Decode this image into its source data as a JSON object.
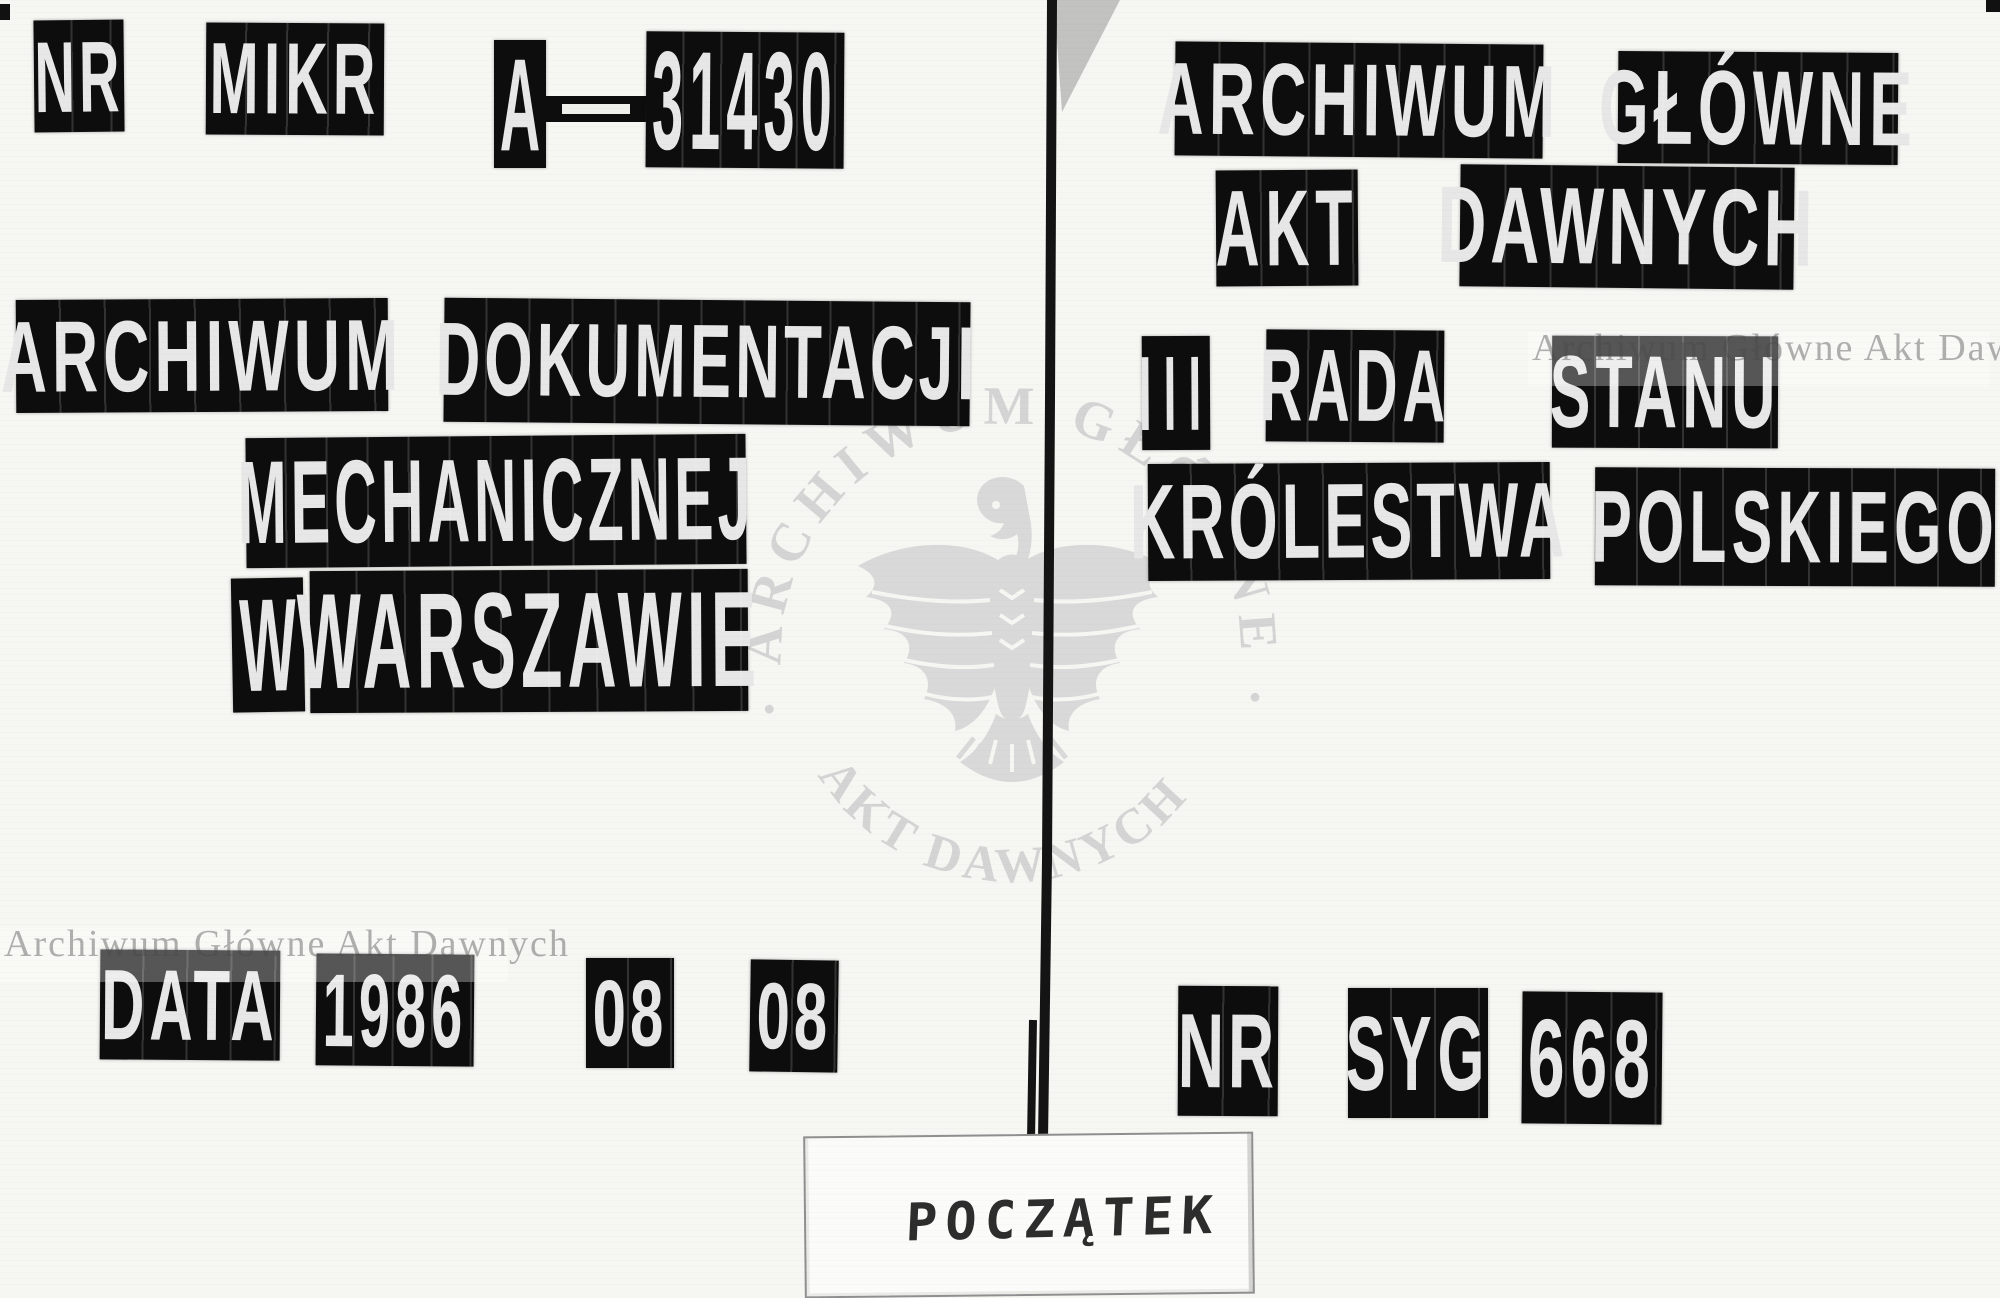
{
  "colors": {
    "ink": "#0d0d0d",
    "paper": "#f6f6f3",
    "letters": "#e7e7e7",
    "watermark_text_gray": "#a9a9a9",
    "stamp_gray": "#d6d6d6"
  },
  "left": {
    "micro": {
      "nr": "NR",
      "mikr": "MIKR",
      "prefix": "A",
      "number": "31430"
    },
    "institution": {
      "w1": "ARCHIWUM",
      "w2": "DOKUMENTACJI",
      "w3": "MECHANICZNEJ",
      "w4": "W",
      "w5": "WARSZAWIE"
    },
    "date": {
      "label": "DATA",
      "year": "1986",
      "month": "08",
      "day": "08"
    }
  },
  "right": {
    "institution": {
      "w1": "ARCHIWUM",
      "w2": "GŁÓWNE",
      "w3": "AKT",
      "w4": "DAWNYCH"
    },
    "fonds": {
      "w1": "III",
      "w2": "RADA",
      "w3": "STANU",
      "w4": "KRÓLESTWA",
      "w5": "POLSKIEGO"
    },
    "signature": {
      "nr": "NR",
      "syg": "SYG",
      "number": "668"
    }
  },
  "watermark": {
    "line": "Archiwum Główne Akt Dawnych",
    "stamp_top": "· ARCHIWUM GŁÓWNE ·",
    "stamp_bottom": "AKT DAWNYCH"
  },
  "slip": {
    "text": "POCZĄTEK"
  }
}
